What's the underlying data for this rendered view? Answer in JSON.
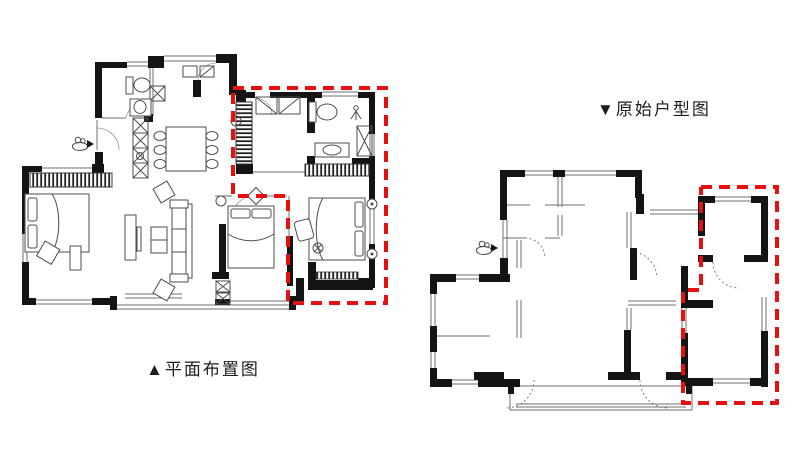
{
  "page": {
    "background": "#ffffff",
    "width": 800,
    "height": 449
  },
  "colors": {
    "wall_black": "#141414",
    "thin_line_gray": "#6f6f6f",
    "furniture_line_gray": "#4d4d4d",
    "annotation_red": "#e80f0f"
  },
  "captions": {
    "left": "▲平面布置图",
    "right": "▼原始户型图"
  },
  "annotations": {
    "dash_pattern": "11 7",
    "left_region_points": "233,88 386,88 386,303 288,303 288,196 233,196 233,88",
    "right_region_points": "701,187 777,187 777,403 683,403 683,290 701,290 701,187"
  },
  "markers": {
    "left_person": "view-direction-figure",
    "right_person": "view-direction-figure"
  }
}
